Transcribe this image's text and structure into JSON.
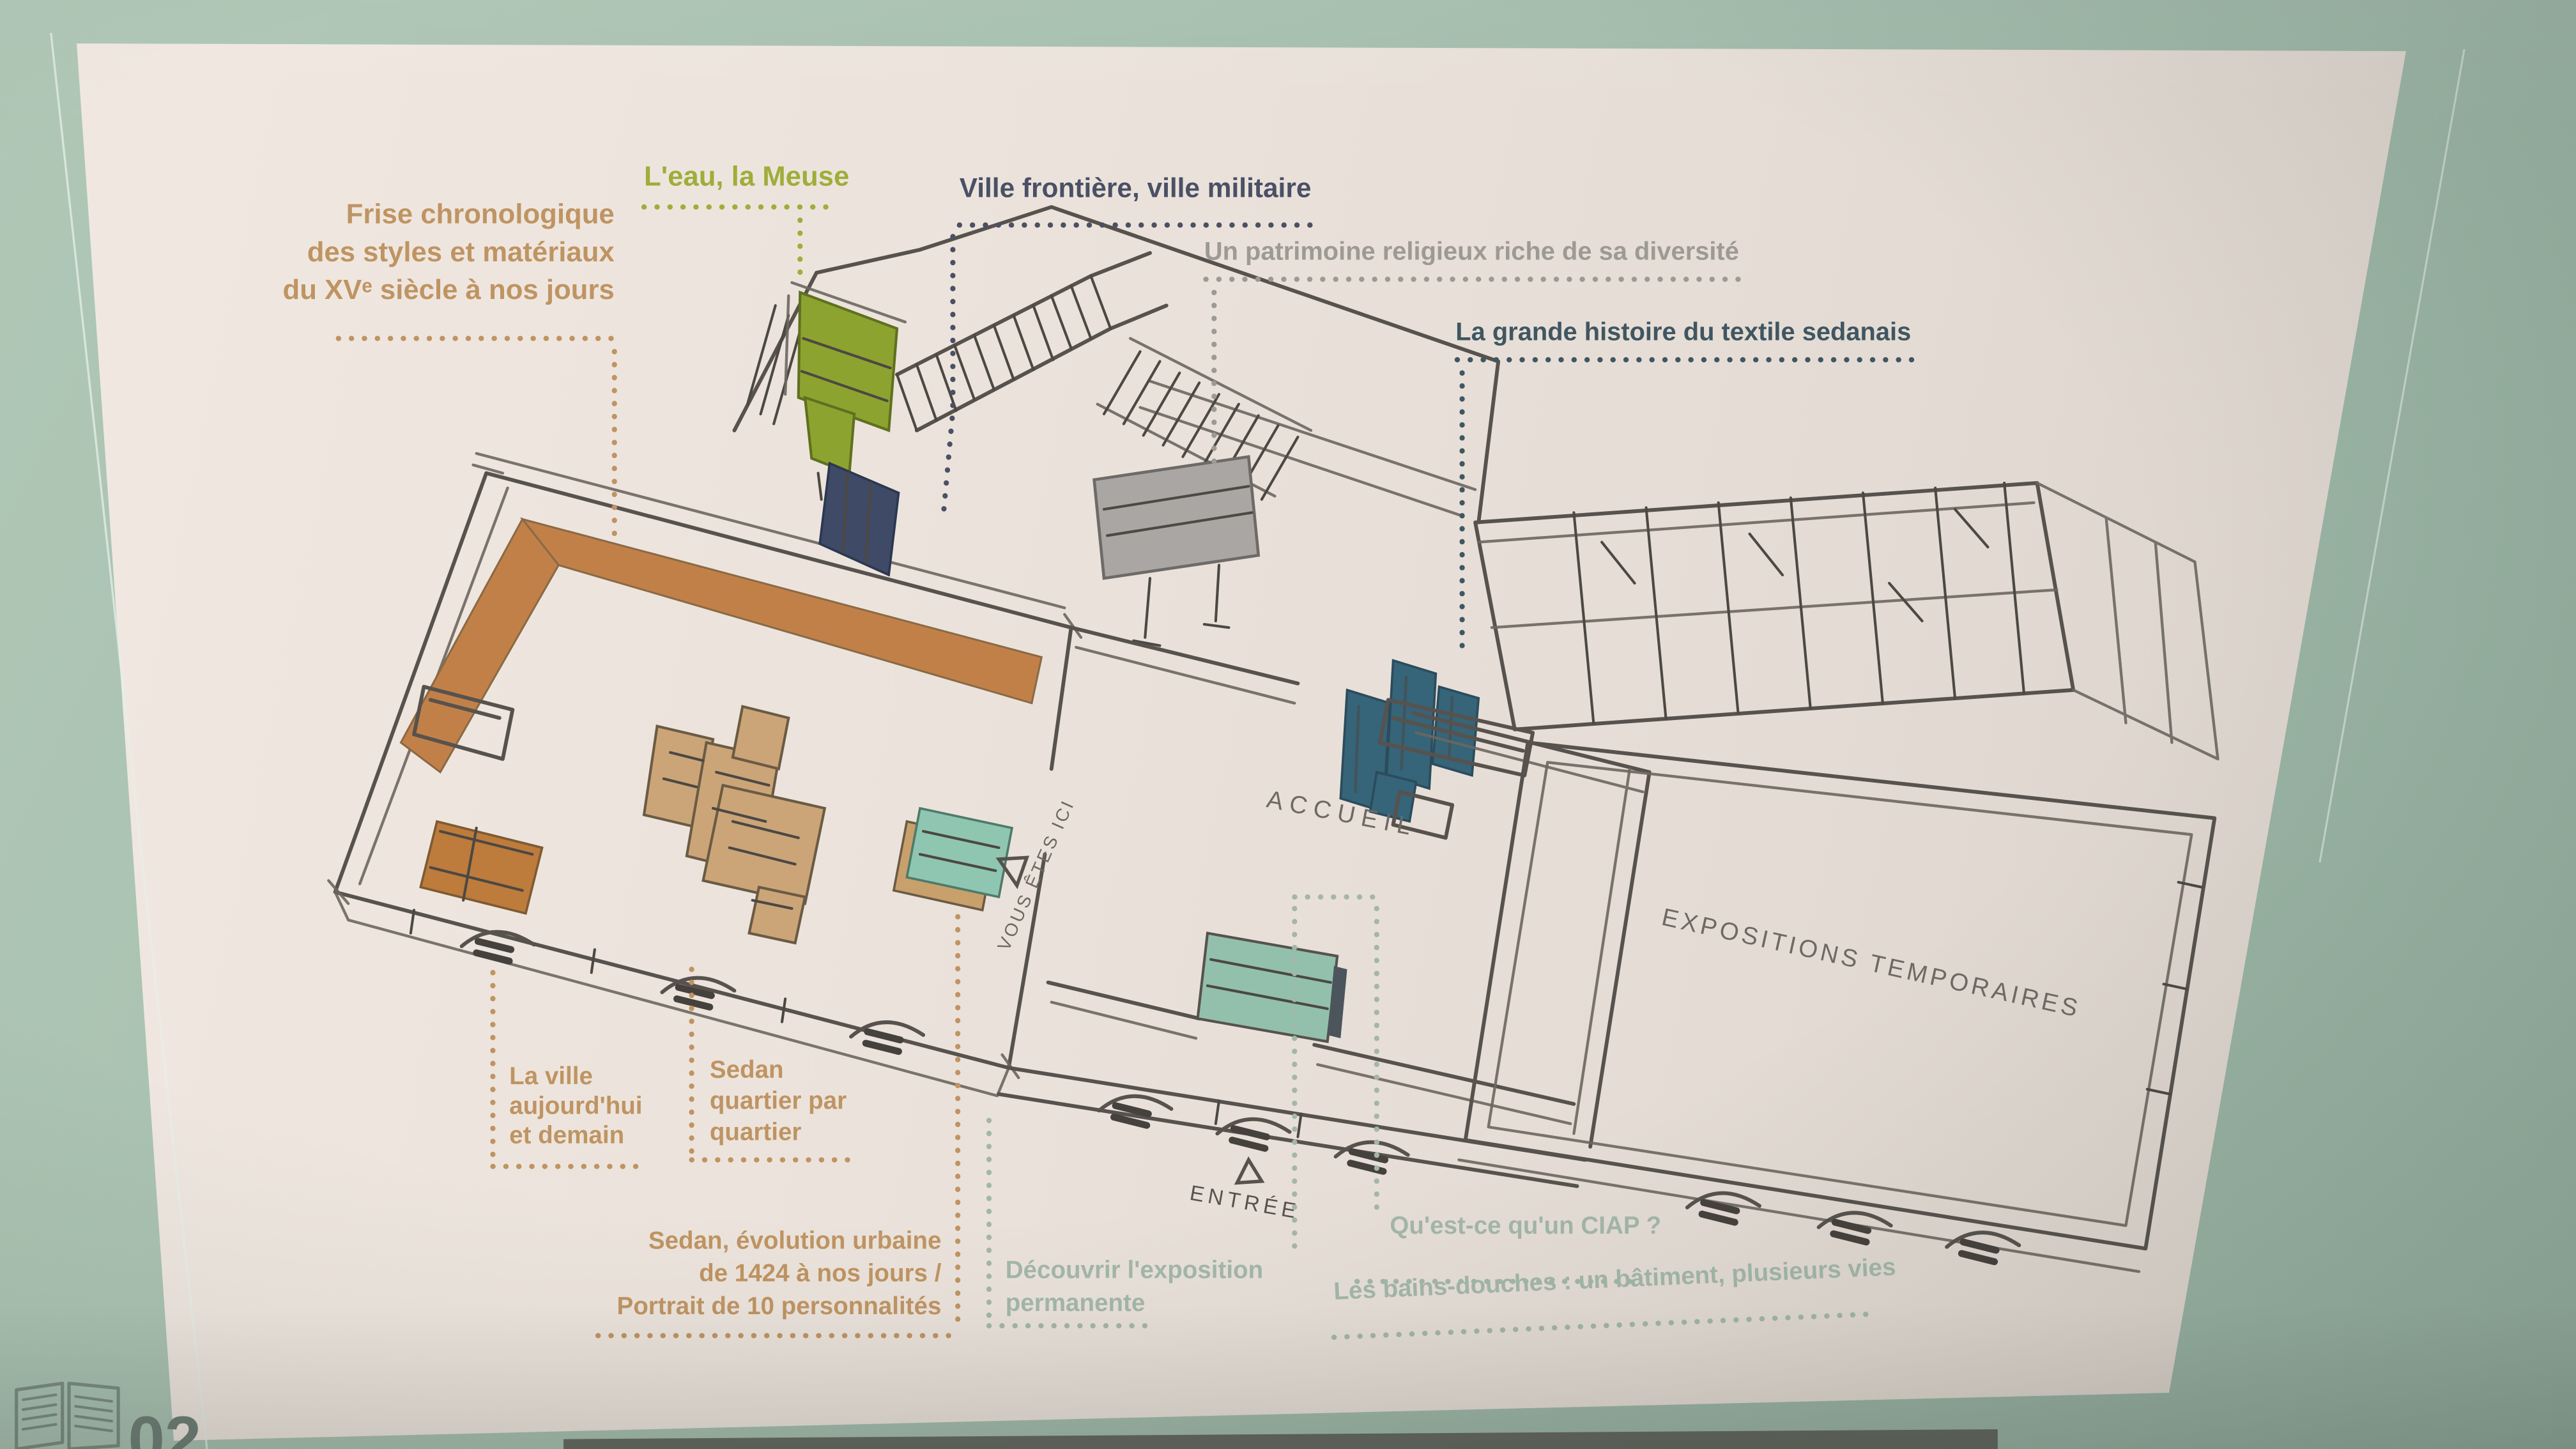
{
  "scene": {
    "background_color": "#a4bdac",
    "poster_color": "#ebe3db",
    "footer": {
      "page_number": "02",
      "icon": "open-book-icon",
      "color": "#6f8076"
    }
  },
  "plan": {
    "style": "hand-drawn isometric museum floor plan",
    "line_color": "#57524d",
    "rooms": {
      "accueil": "ACCUEIL",
      "expositions_temporaires": "EXPOSITIONS TEMPORAIRES"
    },
    "markers": {
      "vous_etes_ici": {
        "label": "VOUS ÊTES ICI",
        "icon": "triangle-icon"
      },
      "entree": {
        "label": "ENTRÉE",
        "icon": "triangle-icon"
      }
    },
    "highlight_colors": {
      "frieze_band": "#c28049",
      "city_model": "#cba578",
      "water_exhibit": "#8da32f",
      "military_cabinet": "#3e4a66",
      "religious_panel": "#a9a6a3",
      "textile_machines": "#366478",
      "here_bench": "#8fc6b1",
      "baths_panel": "#92c0ac"
    }
  },
  "legend": {
    "frise_chronologique": {
      "color": "#bf9463",
      "lines": [
        "Frise chronologique",
        "des styles et matériaux",
        "du XVᵉ siècle à nos jours"
      ]
    },
    "eau_meuse": {
      "color": "#9fad3a",
      "text": "L'eau, la Meuse"
    },
    "ville_frontiere": {
      "color": "#4a5065",
      "text": "Ville frontière, ville militaire"
    },
    "patrimoine_religieux": {
      "color": "#9d9995",
      "text": "Un patrimoine religieux riche de sa diversité"
    },
    "textile_sedanais": {
      "color": "#405662",
      "text": "La grande histoire du textile sedanais"
    },
    "la_ville": {
      "color": "#bf9463",
      "lines": [
        "La ville",
        "aujourd'hui",
        "et demain"
      ]
    },
    "sedan_quartier": {
      "color": "#bf9463",
      "lines": [
        "Sedan",
        "quartier par",
        "quartier"
      ]
    },
    "sedan_evolution": {
      "color": "#bf9463",
      "lines": [
        "Sedan, évolution urbaine",
        "de 1424 à nos jours /",
        "Portrait de 10 personnalités"
      ]
    },
    "decouvrir_expo": {
      "color": "#a3b7a8",
      "lines": [
        "Découvrir l'exposition",
        "permanente"
      ]
    },
    "ciap": {
      "color": "#a3b7a8",
      "text": "Qu'est-ce qu'un CIAP ?"
    },
    "bains_douches": {
      "color": "#a3b7a8",
      "text": "Les bains-douches : un bâtiment, plusieurs vies"
    }
  }
}
